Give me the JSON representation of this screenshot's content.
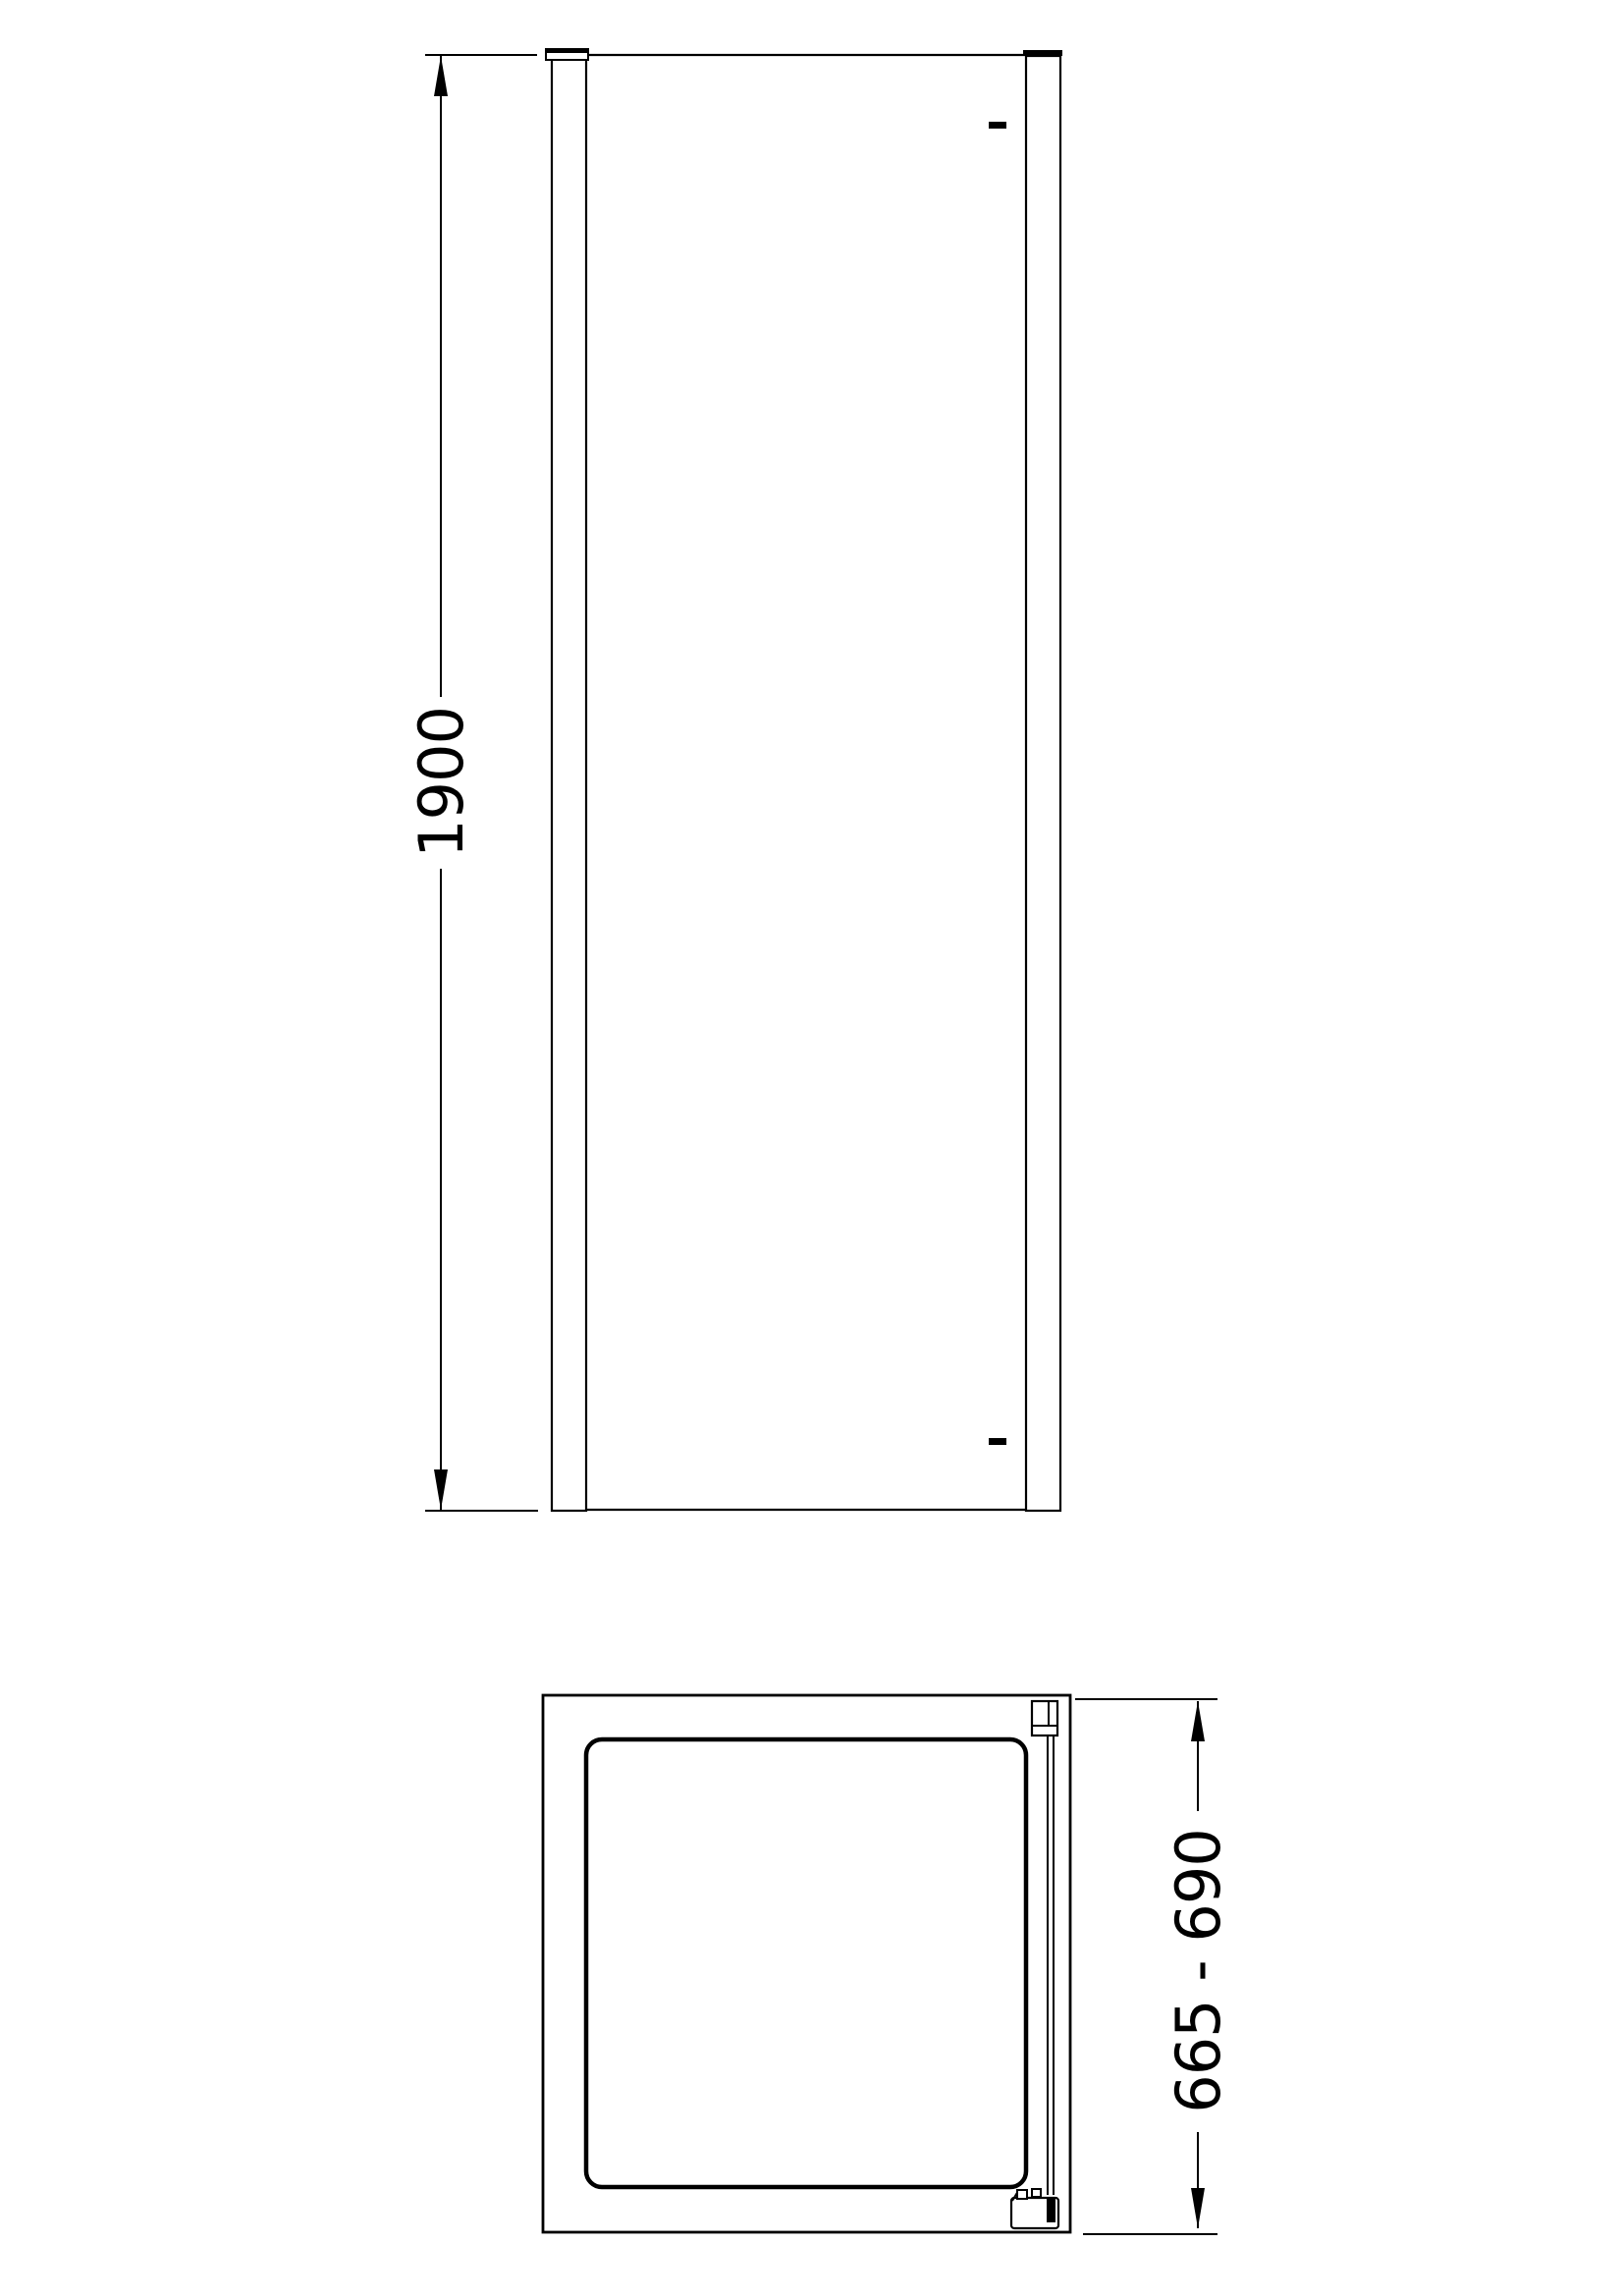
{
  "colors": {
    "background": "#ffffff",
    "line": "#000000"
  },
  "drawing": {
    "elevation": {
      "dimension_label": "1900"
    },
    "plan": {
      "dimension_label": "665 - 690"
    }
  }
}
